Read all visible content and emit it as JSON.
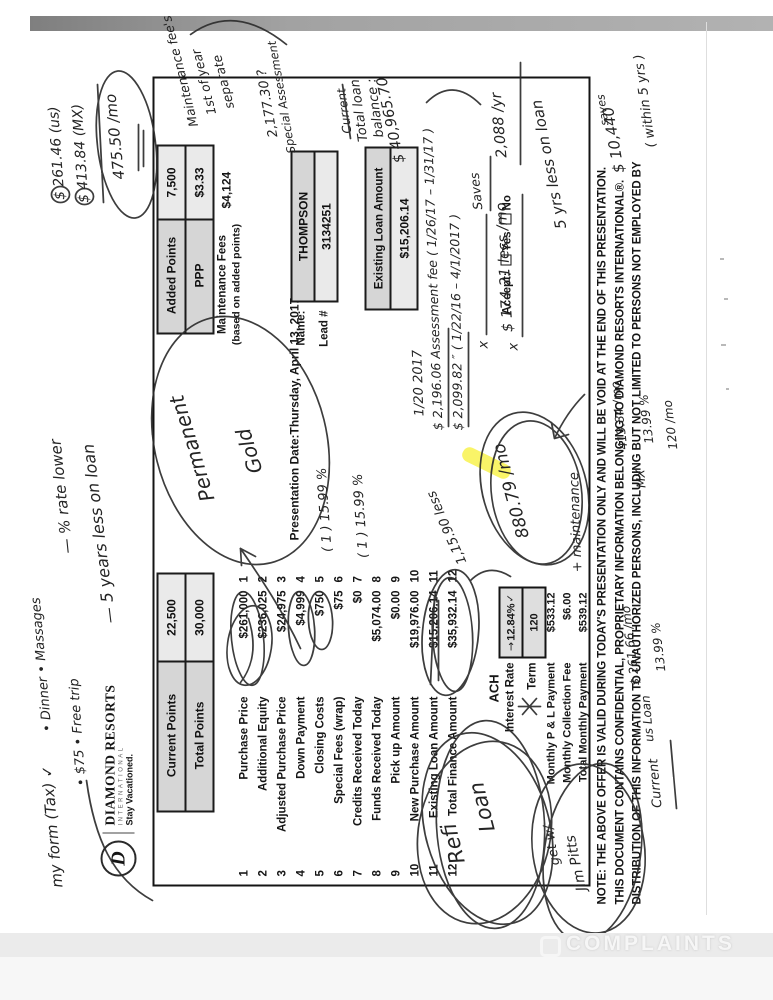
{
  "scan": {
    "watermark": "COMPLAINTS"
  },
  "logo": {
    "d": "D",
    "brand": "DIAMOND RESORTS",
    "intl": "INTERNATIONAL",
    "tagline": "Stay Vacationed."
  },
  "form": {
    "points_boxes": [
      {
        "label": "Current Points",
        "value": "22,500"
      },
      {
        "label": "Total Points",
        "value": "30,000"
      },
      {
        "label": "Added Points",
        "value": "7,500"
      },
      {
        "label": "PPP",
        "value": "$3.33"
      }
    ],
    "maintenance_fees_label": "Maintenance Fees",
    "maintenance_fees_note": "(based on added points)",
    "maintenance_fees_value": "$4,124",
    "presentation_date_label": "Presentation Date:",
    "presentation_date": "Thursday, April 13, 2017",
    "name_label": "Name:",
    "name": "THOMPSON",
    "lead_label": "Lead #",
    "lead": "3134251",
    "existing_loan_label": "Existing Loan Amount",
    "existing_loan_value": "$15,206.14",
    "rows": [
      {
        "num": "1",
        "label": "Purchase Price",
        "value": "$261,000"
      },
      {
        "num": "2",
        "label": "Additional Equity",
        "value": "$236,025"
      },
      {
        "num": "3",
        "label": "Adjusted Purchase Price",
        "value": "$24,975"
      },
      {
        "num": "4",
        "label": "Down Payment",
        "value": "$4,999"
      },
      {
        "num": "5",
        "label": "Closing Costs",
        "value": "$750"
      },
      {
        "num": "6",
        "label": "Special Fees (wrap)",
        "value": "$75"
      },
      {
        "num": "7",
        "label": "Credits Received Today",
        "value": "$0"
      },
      {
        "num": "8",
        "label": "Funds Received Today",
        "value": "$5,074.00"
      },
      {
        "num": "9",
        "label": "Pick up Amount",
        "value": "$0.00"
      },
      {
        "num": "10",
        "label": "New Purchase Amount",
        "value": "$19,976.00"
      },
      {
        "num": "11",
        "label": "Existing Loan Amount",
        "value": "$15,206.14"
      },
      {
        "num": "12",
        "label": "Total Finance Amount",
        "value": "$35,932.14"
      }
    ],
    "ach": "ACH",
    "interest_rate_label": "Interest Rate",
    "interest_rate": "12.84%",
    "term_label": "Term",
    "term": "120",
    "payments": [
      {
        "label": "Monthly P & L Payment",
        "value": "$533.12"
      },
      {
        "label": "Monthly Collection Fee",
        "value": "$6.00"
      },
      {
        "label": "Total Monthly Payment",
        "value": "$539.12"
      }
    ],
    "accept_label": "Accept:",
    "accept_yes": "Yes",
    "accept_no": "No",
    "fine_print": [
      "NOTE:  THE ABOVE OFFER IS VALID DURING TODAY'S PRESENTATION ONLY AND WILL BE VOID AT THE END OF THIS PRESENTATION.",
      "THIS DOCUMENT CONTAINS CONFIDENTIAL, PROPRIETARY INFORMATION BELONGING TO DIAMOND RESORTS INTERNATIONAL®.",
      "DISTRIBUTION OF THIS INFORMATION TO UNAUTHORIZED PERSONS, INCLUDING BUT NOT LIMITED TO PERSONS NOT EMPLOYED BY"
    ]
  },
  "annotations": {
    "form_tax": "my form (Tax) ✓",
    "perks_a": "• Dinner   •  Massages",
    "perks_b": "• $75    •  Free trip",
    "rate_lower": "— % rate lower",
    "yrs_less": "— 5 years less on loan",
    "us_monthly": "$ 261.46  (us)",
    "mx_monthly": "$ 413.84  (MX)",
    "total_monthly": "475.50 /mo",
    "maint_sep_1": "Maintenance fee's",
    "maint_sep_2": "1st of year",
    "maint_sep_3": "separate",
    "special_1": "2,177.30  ?",
    "special_2": "Special Assessment",
    "struck_word": "Current",
    "total_loan_1": "Total loan",
    "total_loan_2": "balance :",
    "total_loan_amt": "$ 40,965.70",
    "assess_date": "1/20      2017",
    "assess_1": "$ 2,196.06   Assessment fee ( 1/26/17 – 1/31/17 )",
    "assess_2": "$ 2,099.82         ″         ( 1/22/16 – 4/1/2017 )",
    "x_mark": "x",
    "saves_small": "Saves",
    "less_per_mo": "$ 174.21   less /mo",
    "less_per_yr": "2,088 /yr",
    "note_880": "880.79 /mo",
    "plus_maintenance": "+ maintenance",
    "note_1159": "1,15.90 less",
    "pct_1599": "( 1 )  15.99 %",
    "permanent": "Permanent",
    "gold": "Gold",
    "refi": "Refi",
    "loan": "Loan",
    "get_w": "get w/",
    "jim_pitts": "Jim Pitts",
    "five_yrs": "5 yrs less on loan",
    "saves_2": "saves",
    "saves_amt": "$ 10,440",
    "within": "( within 5 yrs )",
    "current_word": "Current",
    "us_loan": "us Loan",
    "us_loan_amt": "$ 261.66 /mo",
    "us_loan_rate": "13.99 %",
    "mx_word": "MX",
    "mx_amt": "413.84 /mo",
    "mx_rate": "13.99 %",
    "mx_term": "120 /mo",
    "rate_arrow": "→",
    "rate_check": "✓"
  }
}
